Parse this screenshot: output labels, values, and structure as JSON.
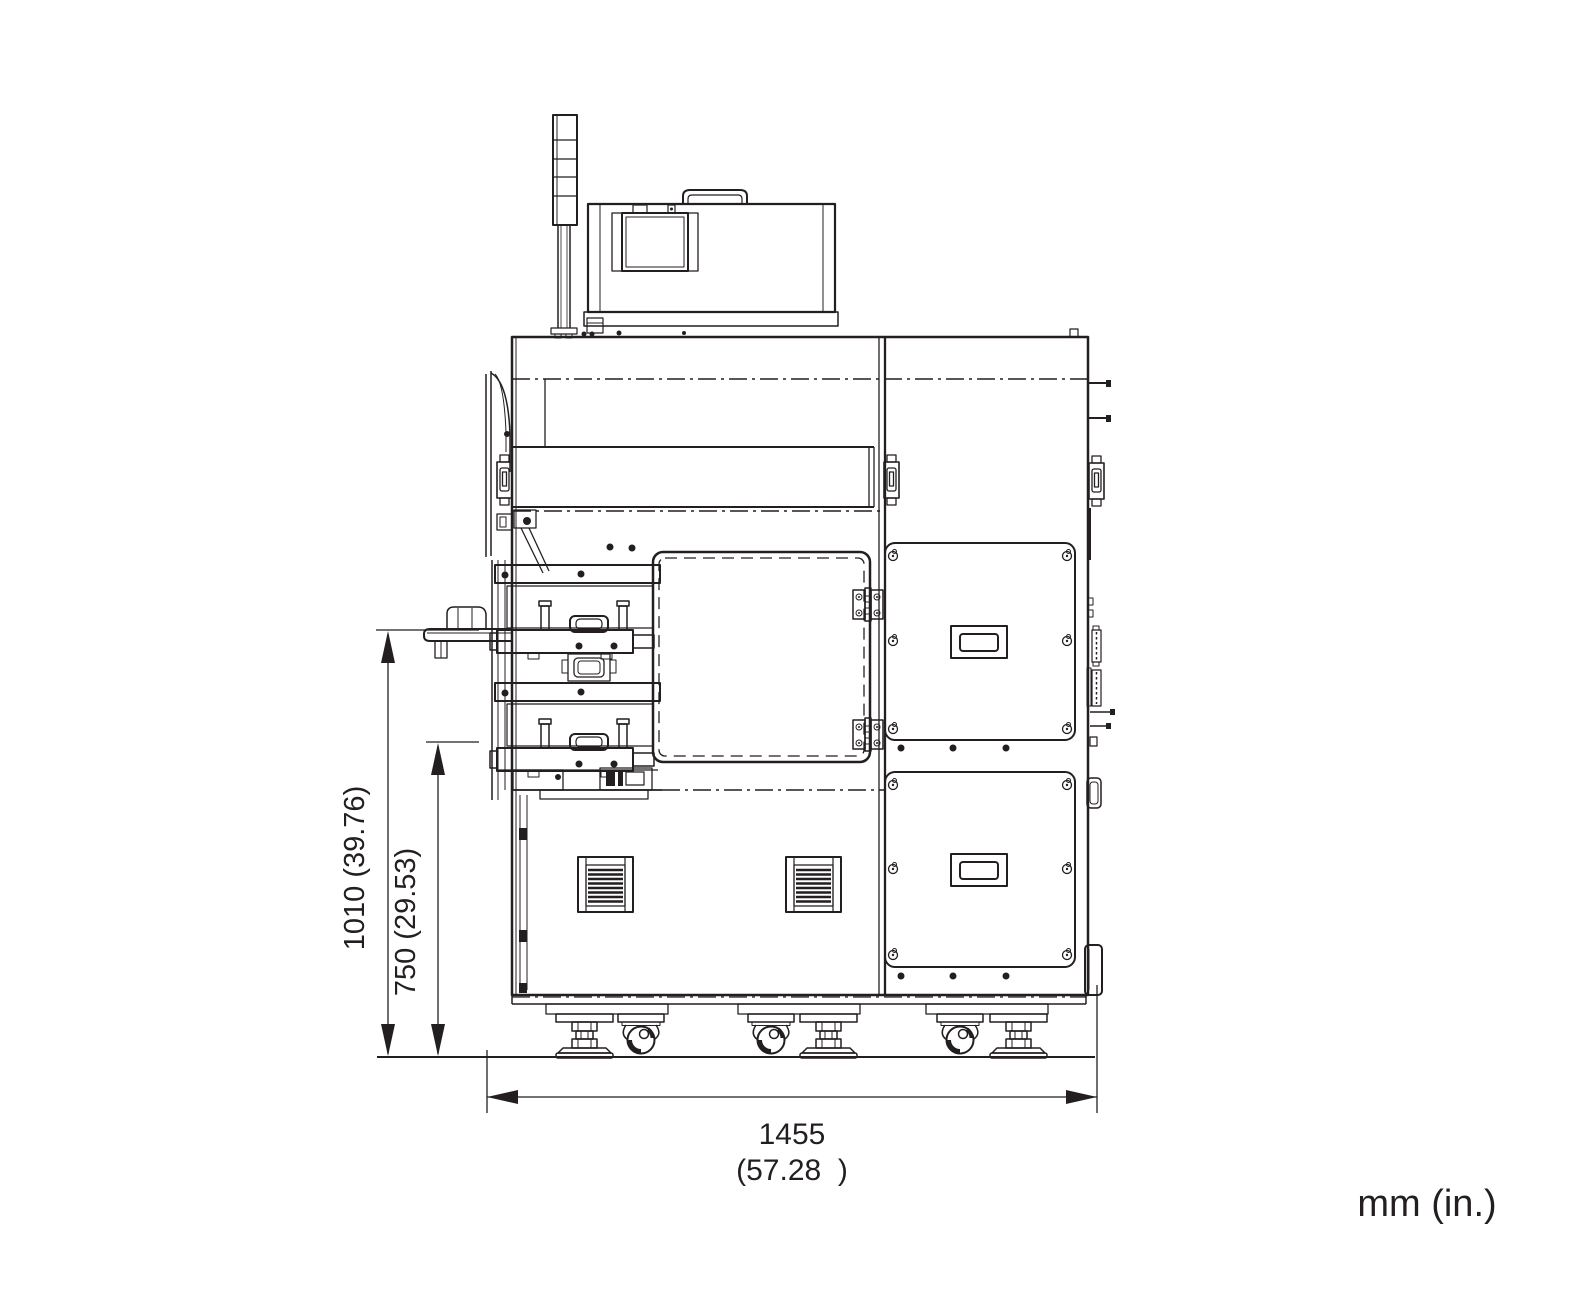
{
  "drawing": {
    "background": "#ffffff",
    "line_color": "#231f20",
    "dimensions": {
      "overall_height": {
        "label": "1010 (39.76)"
      },
      "tray_height": {
        "label": "750 (29.53)"
      },
      "overall_width": {
        "mm": "1455",
        "inches": "(57.28  )"
      }
    },
    "units_note": "mm (in.)"
  }
}
